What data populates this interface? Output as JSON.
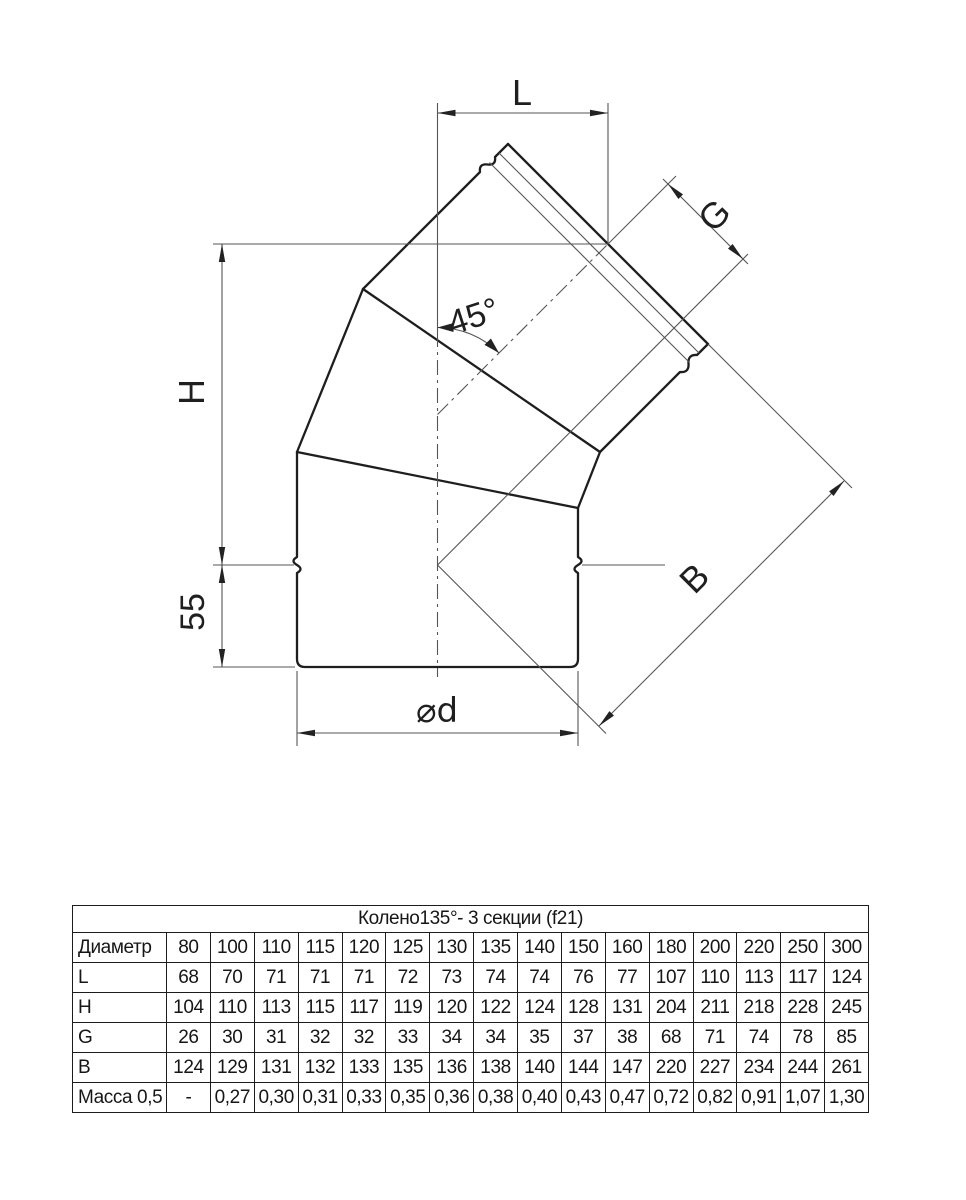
{
  "drawing": {
    "labels": {
      "top_width": "L",
      "socket": "G",
      "height": "H",
      "stub": "55",
      "diagonal": "B",
      "angle": "45°",
      "diameter": "⌀d"
    }
  },
  "table": {
    "title": "Колено135°- 3 секции (f21)",
    "rows": [
      {
        "label": "Диаметр",
        "values": [
          "80",
          "100",
          "110",
          "115",
          "120",
          "125",
          "130",
          "135",
          "140",
          "150",
          "160",
          "180",
          "200",
          "220",
          "250",
          "300"
        ]
      },
      {
        "label": "L",
        "values": [
          "68",
          "70",
          "71",
          "71",
          "71",
          "72",
          "73",
          "74",
          "74",
          "76",
          "77",
          "107",
          "110",
          "113",
          "117",
          "124"
        ]
      },
      {
        "label": "H",
        "values": [
          "104",
          "110",
          "113",
          "115",
          "117",
          "119",
          "120",
          "122",
          "124",
          "128",
          "131",
          "204",
          "211",
          "218",
          "228",
          "245"
        ]
      },
      {
        "label": "G",
        "values": [
          "26",
          "30",
          "31",
          "32",
          "32",
          "33",
          "34",
          "34",
          "35",
          "37",
          "38",
          "68",
          "71",
          "74",
          "78",
          "85"
        ]
      },
      {
        "label": "B",
        "values": [
          "124",
          "129",
          "131",
          "132",
          "133",
          "135",
          "136",
          "138",
          "140",
          "144",
          "147",
          "220",
          "227",
          "234",
          "244",
          "261"
        ]
      },
      {
        "label": "Масса 0,5",
        "values": [
          "-",
          "0,27",
          "0,30",
          "0,31",
          "0,33",
          "0,35",
          "0,36",
          "0,38",
          "0,40",
          "0,43",
          "0,47",
          "0,72",
          "0,82",
          "0,91",
          "1,07",
          "1,30"
        ]
      }
    ]
  }
}
